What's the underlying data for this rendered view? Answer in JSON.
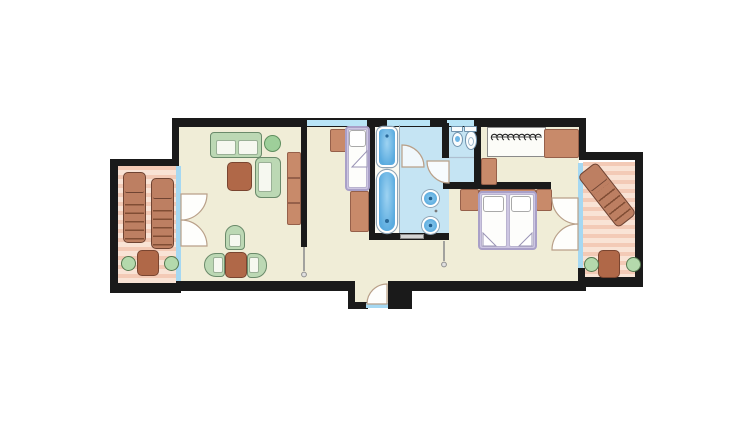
{
  "document": {
    "kind": "apartment-floor-plan",
    "description": "Top-down furnished floor plan of a suite with two terraces, living room, single-bed room, bathroom block and double bedroom",
    "visible_text": [],
    "background_color": "#ffffff"
  },
  "palette": {
    "wall": "#1a1a1a",
    "interior_floor": "#f0edd7",
    "bathroom_floor": "#c5e4f3",
    "terrace_deck_stripe_a": "#f3cab6",
    "terrace_deck_stripe_b": "#f9e3d5",
    "glass": "#a5d8f2",
    "wood_furniture": "#c88a6a",
    "table_wood": "#b06848",
    "upholstery_green": "#bcd8b4",
    "bed_frame_lavender": "#cdc6e2",
    "sanitary_blue": "#5aabdf",
    "door_swing": "#b9a089"
  },
  "rooms": [
    {
      "id": "left-terrace",
      "furniture": [
        "sun-lounger",
        "sun-lounger",
        "patio-table",
        "patio-chair",
        "patio-chair"
      ],
      "floor": "wood-deck"
    },
    {
      "id": "living-room",
      "furniture": [
        "sofa",
        "plant",
        "coffee-table",
        "armchair",
        "sideboard",
        "dining-table",
        "dining-chair",
        "dining-chair",
        "dining-chair"
      ],
      "floor": "cream"
    },
    {
      "id": "single-bed-room",
      "furniture": [
        "single-bed",
        "nightstand",
        "desk"
      ],
      "floor": "cream"
    },
    {
      "id": "shower-tub-cabin",
      "fixtures": [
        "shower-tray",
        "bathtub"
      ],
      "floor": "white"
    },
    {
      "id": "washroom",
      "fixtures": [
        "washbasin",
        "washbasin"
      ],
      "floor": "bath-blue"
    },
    {
      "id": "wc",
      "fixtures": [
        "bidet",
        "toilet"
      ],
      "floor": "bath-blue"
    },
    {
      "id": "bedroom",
      "furniture": [
        "double-bed",
        "nightstand",
        "nightstand",
        "wardrobe-with-hangers",
        "dresser",
        "cabinet"
      ],
      "floor": "cream"
    },
    {
      "id": "right-terrace",
      "furniture": [
        "sun-lounger",
        "patio-table",
        "patio-chair",
        "patio-chair"
      ],
      "floor": "wood-deck"
    },
    {
      "id": "entry-vestibule",
      "fixtures": [
        "entry-door"
      ],
      "floor": "cream"
    }
  ],
  "doors": [
    "terrace-double-door-left",
    "terrace-double-door-right",
    "washroom-door",
    "shower-cabin-door",
    "living-room-door",
    "bedroom-door",
    "entry-door"
  ],
  "windows": [
    "window-above-single-bed",
    "window-above-washroom",
    "window-above-wc"
  ]
}
